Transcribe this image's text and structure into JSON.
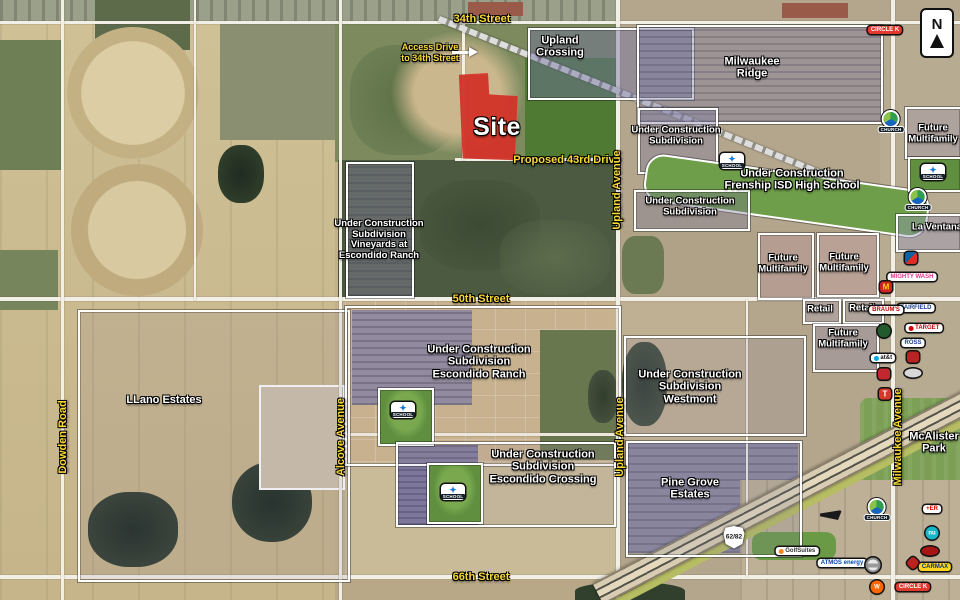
{
  "map": {
    "north_label": "N",
    "site_label": "Site",
    "access_note_line1": "Access Drive",
    "access_note_line2": "to 34th Street",
    "colors": {
      "site_red": "#e93e32",
      "street_label_yellow": "#f8d836",
      "boundary_white": "#ffffff",
      "school_green": "#5f8f3f"
    }
  },
  "streets": [
    {
      "name": "34th-street",
      "text": "34th Street",
      "x": 482,
      "y": 19,
      "vertical": false
    },
    {
      "name": "proposed-43rd-drive",
      "text": "Proposed 43rd Drive",
      "x": 567,
      "y": 160,
      "vertical": false
    },
    {
      "name": "50th-street",
      "text": "50th Street",
      "x": 481,
      "y": 299,
      "vertical": false
    },
    {
      "name": "66th-street",
      "text": "66th Street",
      "x": 481,
      "y": 577,
      "vertical": false
    },
    {
      "name": "upland-avenue-north",
      "text": "Upland Avenue",
      "x": 617,
      "y": 190,
      "vertical": true
    },
    {
      "name": "upland-avenue-south",
      "text": "Upland Avenue",
      "x": 620,
      "y": 437,
      "vertical": true
    },
    {
      "name": "alcove-avenue",
      "text": "Alcove Avenue",
      "x": 341,
      "y": 437,
      "vertical": true
    },
    {
      "name": "dowden-road",
      "text": "Dowden Road",
      "x": 63,
      "y": 437,
      "vertical": true
    },
    {
      "name": "milwaukee-avenue",
      "text": "Milwaukee Avenue",
      "x": 898,
      "y": 437,
      "vertical": true
    }
  ],
  "areas": [
    {
      "name": "upland-crossing",
      "lines": [
        "Upland",
        "Crossing"
      ],
      "x": 560,
      "y": 47,
      "small": false
    },
    {
      "name": "milwaukee-ridge",
      "lines": [
        "Milwaukee",
        "Ridge"
      ],
      "x": 752,
      "y": 68,
      "small": false
    },
    {
      "name": "under-construction-subdivision-1",
      "lines": [
        "Under Construction",
        "Subdivision"
      ],
      "x": 676,
      "y": 136,
      "small": true
    },
    {
      "name": "frenship-isd-high-school",
      "lines": [
        "Under Construction",
        "Frenship ISD High School"
      ],
      "x": 792,
      "y": 180,
      "small": false
    },
    {
      "name": "future-multifamily-northeast",
      "lines": [
        "Future",
        "Multifamily"
      ],
      "x": 933,
      "y": 134,
      "small": true
    },
    {
      "name": "la-ventana",
      "lines": [
        "La Ventana"
      ],
      "x": 937,
      "y": 228,
      "small": true
    },
    {
      "name": "vineyards-at-escondido-ranch",
      "lines": [
        "Under Construction",
        "Subdivision",
        "Vineyards at",
        "Escondido Ranch"
      ],
      "x": 379,
      "y": 240,
      "small": true
    },
    {
      "name": "under-construction-subdivision-2",
      "lines": [
        "Under Construction",
        "Subdivision"
      ],
      "x": 690,
      "y": 207,
      "small": true
    },
    {
      "name": "future-multifamily-1",
      "lines": [
        "Future",
        "Multifamily"
      ],
      "x": 783,
      "y": 264,
      "small": true
    },
    {
      "name": "future-multifamily-2",
      "lines": [
        "Future",
        "Multifamily"
      ],
      "x": 844,
      "y": 263,
      "small": true
    },
    {
      "name": "retail-1",
      "lines": [
        "Retail"
      ],
      "x": 820,
      "y": 310,
      "small": true
    },
    {
      "name": "retail-2",
      "lines": [
        "Retail"
      ],
      "x": 862,
      "y": 309,
      "small": true
    },
    {
      "name": "future-multifamily-3",
      "lines": [
        "Future",
        "Multifamily"
      ],
      "x": 843,
      "y": 339,
      "small": true
    },
    {
      "name": "llano-estates",
      "lines": [
        "LLano Estates"
      ],
      "x": 164,
      "y": 400,
      "small": false
    },
    {
      "name": "escondido-ranch",
      "lines": [
        "Under Construction",
        "Subdivision",
        "Escondido Ranch"
      ],
      "x": 479,
      "y": 362,
      "small": false
    },
    {
      "name": "westmont",
      "lines": [
        "Under Construction",
        "Subdivision",
        "Westmont"
      ],
      "x": 690,
      "y": 387,
      "small": false
    },
    {
      "name": "escondido-crossing",
      "lines": [
        "Under Construction",
        "Subdivision",
        "Escondido Crossing"
      ],
      "x": 543,
      "y": 467,
      "small": false
    },
    {
      "name": "pine-grove-estates",
      "lines": [
        "Pine Grove",
        "Estates"
      ],
      "x": 690,
      "y": 489,
      "small": false
    },
    {
      "name": "mcalister-park",
      "lines": [
        "McAlister",
        "Park"
      ],
      "x": 934,
      "y": 443,
      "small": false
    }
  ],
  "pois": [
    {
      "name": "circle-k-logo-north",
      "kind": "pill",
      "label": "CIRCLE K",
      "fg": "#fff",
      "bg": "#e03a2f",
      "x": 885,
      "y": 30
    },
    {
      "name": "church-icon-1",
      "kind": "church",
      "label": "CHURCH",
      "x": 891,
      "y": 122
    },
    {
      "name": "church-icon-2",
      "kind": "church",
      "label": "CHURCH",
      "x": 918,
      "y": 200
    },
    {
      "name": "church-icon-3",
      "kind": "church",
      "label": "CHURCH",
      "x": 877,
      "y": 510
    },
    {
      "name": "school-icon-frenship",
      "kind": "school",
      "label": "SCHOOL",
      "x": 732,
      "y": 161
    },
    {
      "name": "school-icon-northeast",
      "kind": "school",
      "label": "SCHOOL",
      "x": 933,
      "y": 172
    },
    {
      "name": "school-icon-escondido-ranch",
      "kind": "school",
      "label": "SCHOOL",
      "x": 403,
      "y": 410
    },
    {
      "name": "school-icon-escondido-crossing",
      "kind": "school",
      "label": "SCHOOL",
      "x": 453,
      "y": 492
    },
    {
      "name": "dominos-logo",
      "kind": "domino",
      "label": "",
      "x": 911,
      "y": 258
    },
    {
      "name": "mighty-wash-logo",
      "kind": "pill",
      "label": "MIGHTY WASH",
      "fg": "#e0368c",
      "bg": "#fff",
      "x": 912,
      "y": 277
    },
    {
      "name": "mcdonalds-logo",
      "kind": "square",
      "label": "M",
      "fg": "#ffd200",
      "bg": "#cc2222",
      "x": 886,
      "y": 287
    },
    {
      "name": "fairfield-inn-logo",
      "kind": "pill",
      "label": "FAIRFIELD",
      "fg": "#1b3f8f",
      "bg": "#fff",
      "x": 916,
      "y": 308
    },
    {
      "name": "braums-logo",
      "kind": "pill",
      "label": "BRAUM'S",
      "fg": "#c40000",
      "bg": "#fff",
      "x": 886,
      "y": 310
    },
    {
      "name": "target-logo",
      "kind": "pill",
      "label": "TARGET",
      "fg": "#cc0000",
      "bg": "#fff",
      "dot": "#cc0000",
      "x": 924,
      "y": 328
    },
    {
      "name": "market-street-logo",
      "kind": "circle",
      "label": "",
      "fg": "#fff",
      "bg": "#205a2d",
      "x": 884,
      "y": 331
    },
    {
      "name": "ross-logo",
      "kind": "pill",
      "label": "ROSS",
      "fg": "#1b3f8f",
      "bg": "#fff",
      "x": 913,
      "y": 343
    },
    {
      "name": "red-banner-logo",
      "kind": "square",
      "label": "",
      "fg": "#fff",
      "bg": "#bb2222",
      "x": 913,
      "y": 357
    },
    {
      "name": "att-logo",
      "kind": "pill",
      "label": "at&t",
      "fg": "#111",
      "bg": "#fff",
      "dot": "#00a8e0",
      "x": 883,
      "y": 358
    },
    {
      "name": "slanted-auto-logo",
      "kind": "oval",
      "bg": "#d8d8d8",
      "x": 913,
      "y": 373
    },
    {
      "name": "rosas-cafe-logo",
      "kind": "square",
      "label": "",
      "fg": "#ffd700",
      "bg": "#c1272d",
      "x": 884,
      "y": 374
    },
    {
      "name": "torchys-tacos-logo",
      "kind": "square",
      "label": "T",
      "fg": "#fff",
      "bg": "#d43a2a",
      "x": 885,
      "y": 394
    },
    {
      "name": "highway-62-82-shield",
      "kind": "shield",
      "label": "62/82",
      "x": 734,
      "y": 537
    },
    {
      "name": "dealer-arrow-logo",
      "kind": "wedge",
      "bg": "#1a1a1a",
      "x": 831,
      "y": 515
    },
    {
      "name": "er-logo",
      "kind": "pill",
      "label": "+ER",
      "fg": "#d00000",
      "bg": "#fff",
      "x": 932,
      "y": 509
    },
    {
      "name": "nu-logo",
      "kind": "circle",
      "label": "nu",
      "fg": "#fff",
      "bg": "#19b5c8",
      "x": 932,
      "y": 533
    },
    {
      "name": "golfsuites-logo",
      "kind": "pill",
      "label": "GolfSuites",
      "fg": "#333",
      "bg": "#fff",
      "dot": "#f6871f",
      "x": 797,
      "y": 551
    },
    {
      "name": "hotel-oval-logo",
      "kind": "oval",
      "bg": "#a81515",
      "x": 930,
      "y": 551
    },
    {
      "name": "atmos-energy-logo",
      "kind": "pill",
      "label": "ATMOS energy",
      "fg": "#0047ab",
      "bg": "#fff",
      "x": 842,
      "y": 563
    },
    {
      "name": "nissan-logo",
      "kind": "ring",
      "label": "",
      "x": 873,
      "y": 565
    },
    {
      "name": "red-diamond-logo",
      "kind": "diamond",
      "bg": "#bb2222",
      "x": 913,
      "y": 563
    },
    {
      "name": "carmax-logo",
      "kind": "pill",
      "label": "CARMAX",
      "fg": "#003087",
      "bg": "#ffd520",
      "x": 935,
      "y": 567
    },
    {
      "name": "whataburger-logo",
      "kind": "circle",
      "label": "W",
      "fg": "#fff",
      "bg": "#ff6600",
      "x": 877,
      "y": 587
    },
    {
      "name": "circle-k-logo-south",
      "kind": "pill",
      "label": "CIRCLE K",
      "fg": "#fff",
      "bg": "#e03a2f",
      "x": 913,
      "y": 587
    }
  ]
}
